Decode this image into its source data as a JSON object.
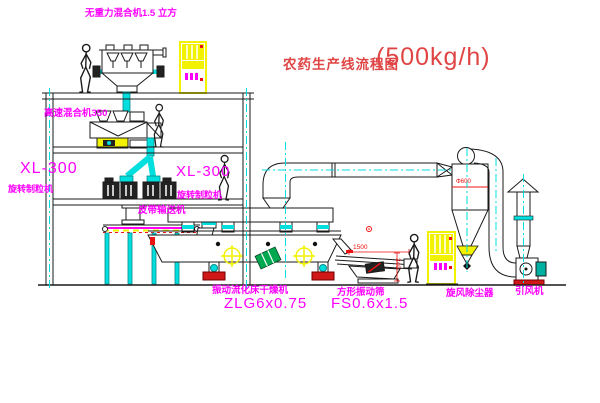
{
  "title": {
    "text": "农药生产线流程图",
    "capacity": "(500kg/h)"
  },
  "labels": {
    "gravity_mixer": "无重力混合机1.5 立方",
    "high_speed_mixer": "高速混合机350",
    "granulator_left_model": "XL-300",
    "granulator_left_name": "旋转制粒机",
    "granulator_right_model": "XL-300",
    "granulator_right_name": "旋转制粒机",
    "belt_conveyor": "皮带输送机",
    "dryer_name": "振动流化床干燥机",
    "dryer_model": "ZLG6x0.75",
    "screen_name": "方形振动筛",
    "screen_model": "FS0.6x1.5",
    "cyclone": "旋风除尘器",
    "fan": "引风机"
  },
  "dimensions": {
    "cyclone_diameter": "Φ600",
    "screen_length": "1500",
    "screen_outlet_height": "340"
  },
  "colors": {
    "label_magenta": "#ff00ff",
    "title_red": "#e04545",
    "dimension_red": "#ee1111",
    "centerline_cyan": "#00dede",
    "cabinet_yellow": "#f2f200",
    "cylinder_green": "#00a84f",
    "line_black": "#1a1a1a"
  }
}
